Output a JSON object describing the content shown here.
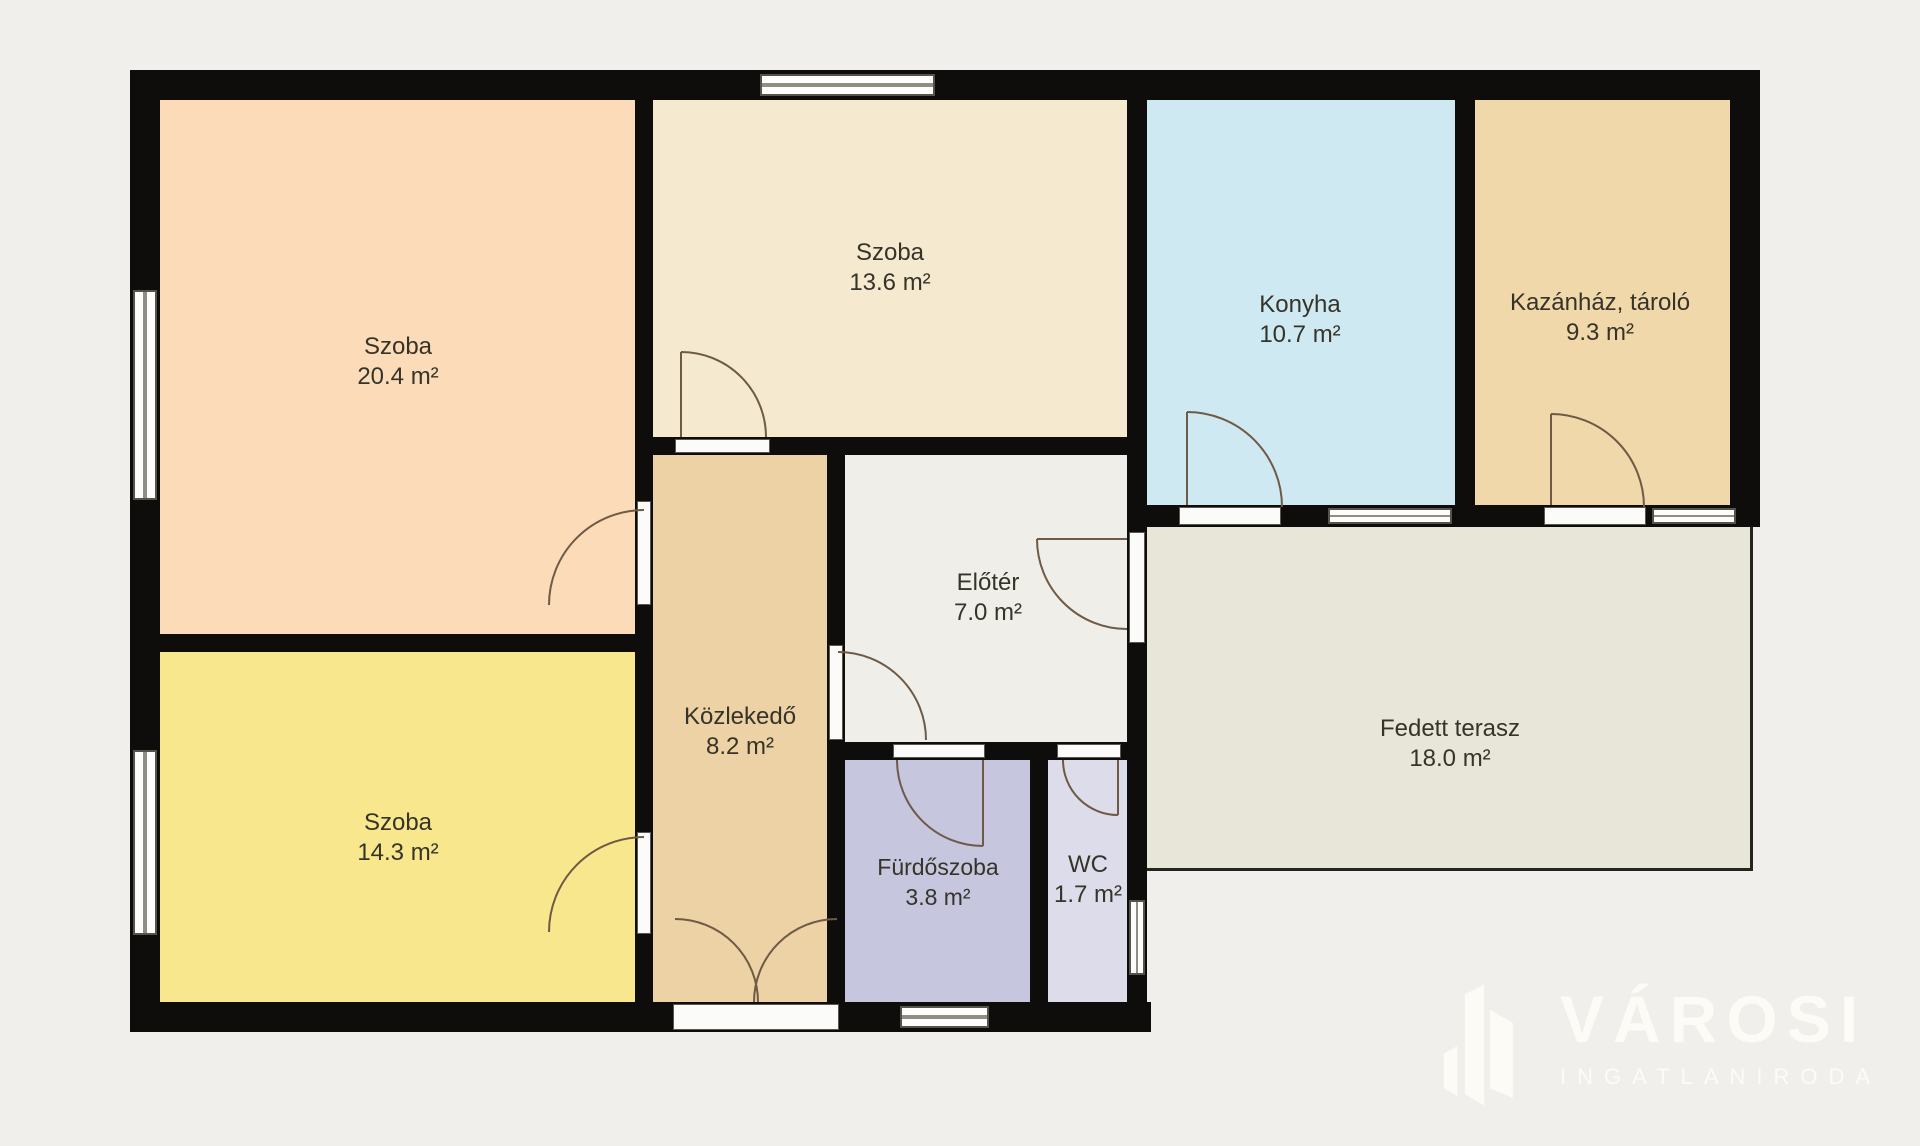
{
  "plan": {
    "background_color": "#f0efec",
    "wall_color": "#0e0d0b",
    "label_text_color": "#363329",
    "door_arc_color": "#6e5a45",
    "terrace_outline_color": "#26241f"
  },
  "rooms": [
    {
      "id": "szoba-nagy",
      "name": "Szoba",
      "area": "20.4 m²",
      "color": "#fcdcb8"
    },
    {
      "id": "szoba-kozep",
      "name": "Szoba",
      "area": "13.6 m²",
      "color": "#f5ead0"
    },
    {
      "id": "konyha",
      "name": "Konyha",
      "area": "10.7 m²",
      "color": "#cfe9f2"
    },
    {
      "id": "kazanhaz",
      "name": "Kazánház, tároló",
      "area": "9.3 m²",
      "color": "#f0d8ab"
    },
    {
      "id": "szoba-kis",
      "name": "Szoba",
      "area": "14.3 m²",
      "color": "#f8e78c"
    },
    {
      "id": "kozlekedo",
      "name": "Közlekedő",
      "area": "8.2 m²",
      "color": "#ecd2a4"
    },
    {
      "id": "eloter",
      "name": "Előtér",
      "area": "7.0 m²",
      "color": "#efeee9"
    },
    {
      "id": "furdoszoba",
      "name": "Fürdőszoba",
      "area": "3.8 m²",
      "color": "#c6c6de"
    },
    {
      "id": "wc",
      "name": "WC",
      "area": "1.7 m²",
      "color": "#dcdcea"
    },
    {
      "id": "fedett-terasz",
      "name": "Fedett terasz",
      "area": "18.0 m²",
      "color": "#e8e5d9"
    }
  ],
  "logo": {
    "title": "VÁROSI",
    "subtitle": "INGATLANIRODA",
    "color": "#fcfbf6"
  }
}
